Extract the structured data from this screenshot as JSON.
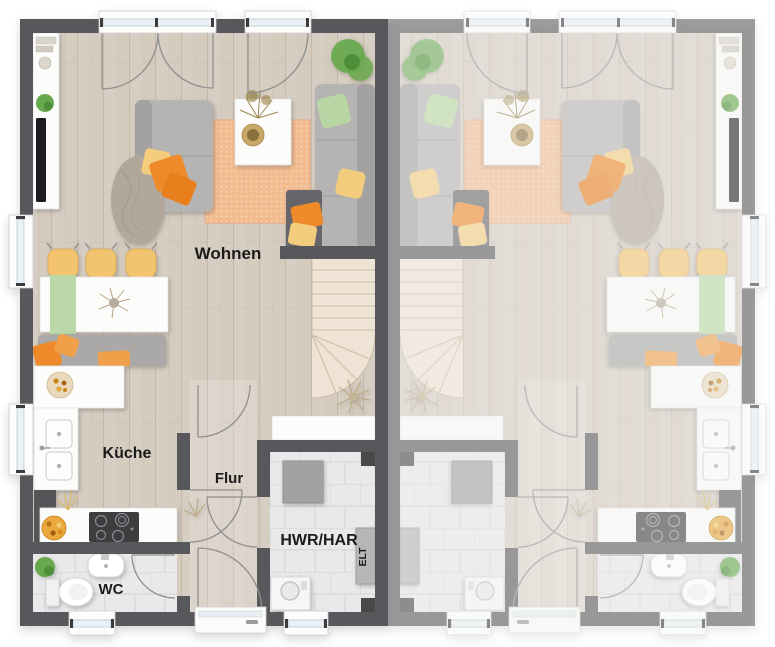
{
  "labels": {
    "living": "Wohnen",
    "kitchen": "Küche",
    "hallway": "Flur",
    "utility": "HWR/HAR",
    "electrical": "ELT",
    "wc": "WC"
  },
  "colors": {
    "wall": "#58595b",
    "wallDark": "#48484a",
    "floor": "#d5cbbf",
    "stairs": "#eee3d4",
    "tile": "#e9e9eb",
    "rug": "#f3bd92",
    "counter": "#fcfcfa",
    "sofa": "#b5b4b2",
    "sofaBack": "#a3a2a0",
    "blanket": "#b2a79b",
    "orange": "#ee8a2b",
    "orangeSoft": "#f0a048",
    "yellow": "#f3cd7d",
    "green": "#b7d6a3",
    "chair": "#f3c46f",
    "plant": "#67a94e",
    "appliance": "#a2a2a4",
    "cooktop": "#3c3c40",
    "glass": "#e9f1f6",
    "arc": "#8f8f8f",
    "text": "#1b1b1b"
  }
}
